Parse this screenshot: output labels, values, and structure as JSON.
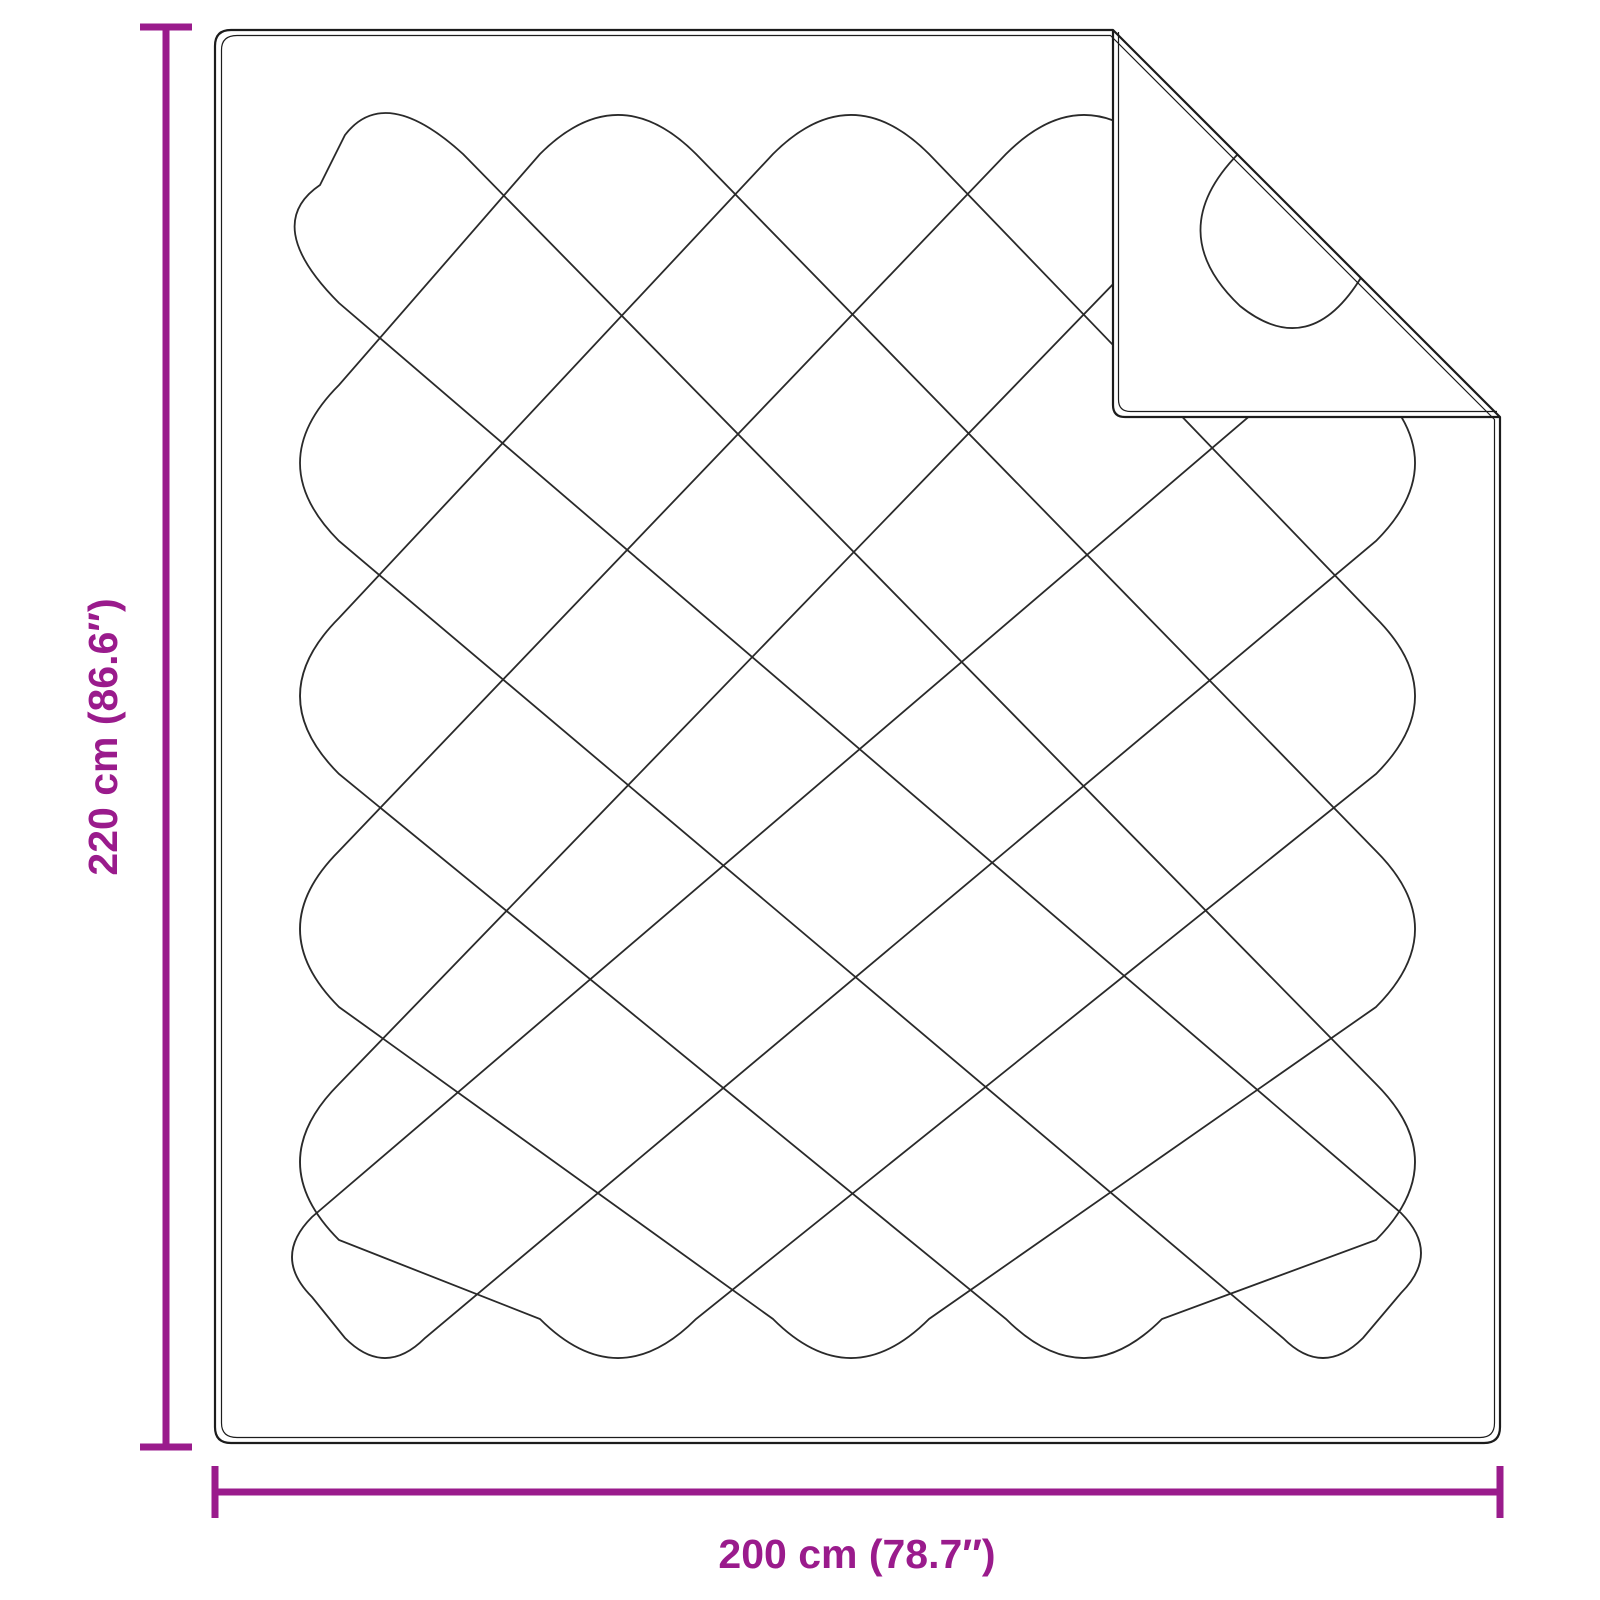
{
  "diagram": {
    "kind": "product-dimension-diagram",
    "subject": "quilted-blanket-with-folded-corner",
    "background_color": "#ffffff",
    "outline_color": "#1c1c1c",
    "stitch_line_color": "#2a2a2a",
    "accent_color": "#9A1B8C"
  },
  "dimensions": {
    "height": {
      "label": "220 cm (86.6″)",
      "value_cm": 220,
      "value_inch": 86.6
    },
    "width": {
      "label": "200 cm (78.7″)",
      "value_cm": 200,
      "value_inch": 78.7
    }
  }
}
